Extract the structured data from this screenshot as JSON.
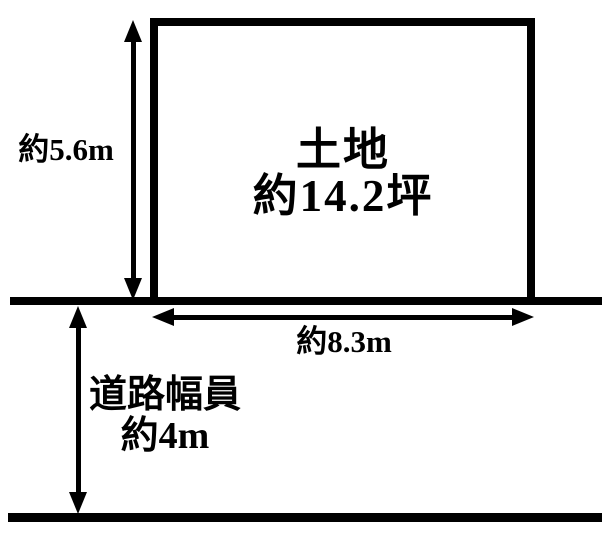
{
  "diagram": {
    "type": "land-plot",
    "colors": {
      "line": "#000000",
      "background": "#ffffff",
      "text": "#000000"
    },
    "land": {
      "name": "土地",
      "area": "約14.2坪"
    },
    "depth_dimension": {
      "label": "約5.6m"
    },
    "frontage_dimension": {
      "label": "約8.3m"
    },
    "road": {
      "label_line1": "道路幅員",
      "label_line2": "約4m"
    }
  }
}
